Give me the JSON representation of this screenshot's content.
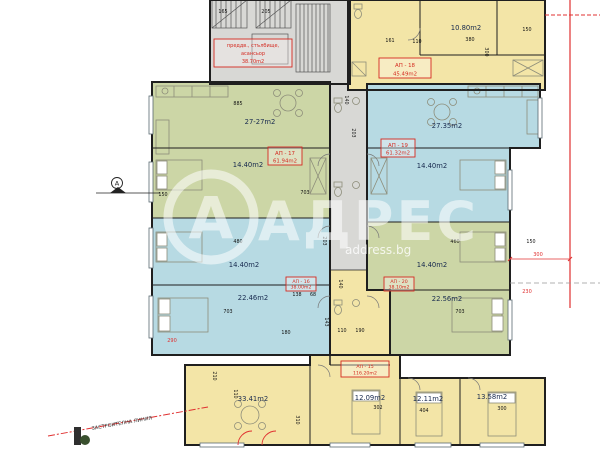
{
  "colors": {
    "green": "#ccd6a6",
    "blue": "#b7dae3",
    "yellow": "#f3e5a7",
    "gray": "#d8d8d5",
    "red": "#d42a20",
    "navy": "#17294e",
    "wall": "#1f1f1f",
    "redline": "#e03030"
  },
  "watermark": {
    "letter": "А",
    "brand": "АДРЕС",
    "site": "address.bg"
  },
  "plan": {
    "core_label": [
      "преддв., стълбище,",
      "асансьор",
      "38.70m2"
    ],
    "building_line": "ЗАСТРОИТЕЛНА ЛИНИЯ",
    "axis_letter": "А",
    "apartment_labels": [
      {
        "id": "АП - 17",
        "area": "61.94m2",
        "x": 268,
        "y": 147,
        "w": 34,
        "h": 18
      },
      {
        "id": "АП - 18",
        "area": "45.49m2",
        "x": 379,
        "y": 58,
        "w": 52,
        "h": 20
      },
      {
        "id": "АП - 19",
        "area": "61.32m2",
        "x": 381,
        "y": 139,
        "w": 34,
        "h": 18
      },
      {
        "id": "АП - 16",
        "area": "38.00m2",
        "x": 286,
        "y": 277,
        "w": 30,
        "h": 14
      },
      {
        "id": "АП - 20",
        "area": "38.10m2",
        "x": 384,
        "y": 277,
        "w": 30,
        "h": 14
      },
      {
        "id": "АП - 15",
        "area": "116.20m2",
        "x": 341,
        "y": 361,
        "w": 48,
        "h": 16
      }
    ],
    "area_labels": [
      {
        "t": "27-27m2",
        "x": 260,
        "y": 124
      },
      {
        "t": "27.35m2",
        "x": 447,
        "y": 128
      },
      {
        "t": "14.40m2",
        "x": 248,
        "y": 167
      },
      {
        "t": "14.40m2",
        "x": 432,
        "y": 168
      },
      {
        "t": "14.40m2",
        "x": 244,
        "y": 267
      },
      {
        "t": "14.40m2",
        "x": 432,
        "y": 267
      },
      {
        "t": "22.46m2",
        "x": 253,
        "y": 300
      },
      {
        "t": "22.56m2",
        "x": 447,
        "y": 301
      },
      {
        "t": "10.80m2",
        "x": 466,
        "y": 30
      },
      {
        "t": "33.41m2",
        "x": 253,
        "y": 401
      },
      {
        "t": "12.09m2",
        "x": 370,
        "y": 400
      },
      {
        "t": "12.11m2",
        "x": 428,
        "y": 401
      },
      {
        "t": "13.58m2",
        "x": 492,
        "y": 399
      }
    ],
    "dim_labels": [
      {
        "t": "165",
        "x": 223,
        "y": 13
      },
      {
        "t": "205",
        "x": 266,
        "y": 13
      },
      {
        "t": "885",
        "x": 238,
        "y": 105
      },
      {
        "t": "110",
        "x": 417,
        "y": 43
      },
      {
        "t": "161",
        "x": 390,
        "y": 42
      },
      {
        "t": "380",
        "x": 470,
        "y": 41
      },
      {
        "t": "300",
        "x": 485,
        "y": 52,
        "r": 90
      },
      {
        "t": "150",
        "x": 527,
        "y": 31
      },
      {
        "t": "140",
        "x": 345,
        "y": 100,
        "r": 90
      },
      {
        "t": "203",
        "x": 352,
        "y": 133,
        "r": 90
      },
      {
        "t": "703",
        "x": 305,
        "y": 194
      },
      {
        "t": "150",
        "x": 163,
        "y": 196
      },
      {
        "t": "480",
        "x": 238,
        "y": 243
      },
      {
        "t": "203",
        "x": 323,
        "y": 241,
        "r": 90
      },
      {
        "t": "460",
        "x": 455,
        "y": 243
      },
      {
        "t": "150",
        "x": 531,
        "y": 243
      },
      {
        "t": "703",
        "x": 228,
        "y": 313
      },
      {
        "t": "703",
        "x": 460,
        "y": 313
      },
      {
        "t": "138",
        "x": 297,
        "y": 296
      },
      {
        "t": "68",
        "x": 313,
        "y": 296
      },
      {
        "t": "140",
        "x": 339,
        "y": 284,
        "r": 90
      },
      {
        "t": "110",
        "x": 342,
        "y": 332
      },
      {
        "t": "190",
        "x": 360,
        "y": 332
      },
      {
        "t": "180",
        "x": 286,
        "y": 334
      },
      {
        "t": "143",
        "x": 325,
        "y": 322,
        "r": 90
      },
      {
        "t": "210",
        "x": 213,
        "y": 376,
        "r": 90
      },
      {
        "t": "110",
        "x": 234,
        "y": 394,
        "r": 90
      },
      {
        "t": "310",
        "x": 296,
        "y": 420,
        "r": 90
      },
      {
        "t": "302",
        "x": 378,
        "y": 409
      },
      {
        "t": "404",
        "x": 424,
        "y": 412
      },
      {
        "t": "300",
        "x": 502,
        "y": 410
      }
    ],
    "red_marks": [
      {
        "t": "300",
        "x": 538,
        "y": 256
      },
      {
        "t": "230",
        "x": 527,
        "y": 293
      },
      {
        "t": "290",
        "x": 172,
        "y": 342
      }
    ]
  }
}
